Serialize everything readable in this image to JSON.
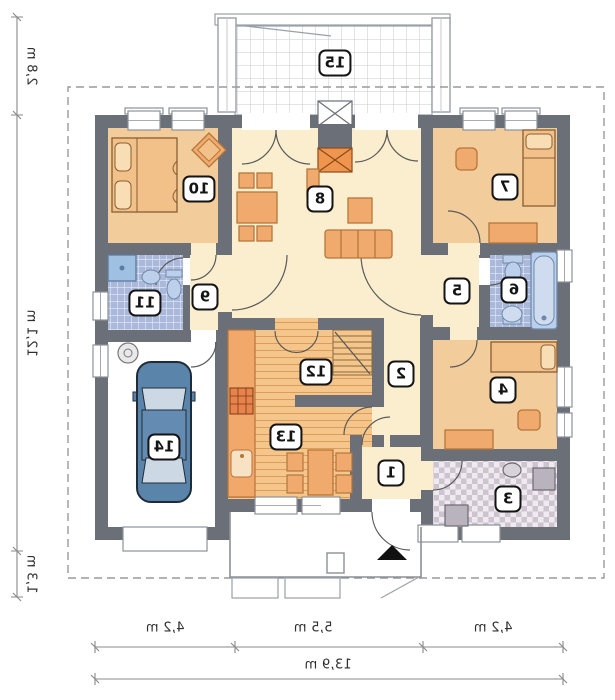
{
  "title": "Single-storey house floor plan (mirrored print)",
  "rooms": [
    {
      "number": "1"
    },
    {
      "number": "2"
    },
    {
      "number": "3"
    },
    {
      "number": "4"
    },
    {
      "number": "5"
    },
    {
      "number": "6"
    },
    {
      "number": "7"
    },
    {
      "number": "8"
    },
    {
      "number": "9"
    },
    {
      "number": "10"
    },
    {
      "number": "11"
    },
    {
      "number": "12"
    },
    {
      "number": "13"
    },
    {
      "number": "14"
    },
    {
      "number": "15"
    }
  ],
  "dimensions": {
    "vertical": [
      "2,8 m",
      "12,1 m",
      "1,3 m"
    ],
    "horizontal": [
      "4,2 m",
      "5,5 m",
      "4,2 m"
    ],
    "total_width": "13,9 m"
  },
  "markers": {
    "entrance_arrow": "▲"
  },
  "colors": {
    "wall": "#6b6f78",
    "floor_cream": "#faeecf",
    "floor_tan": "#f2cc9b",
    "furniture_orange": "#f0aa6e",
    "tile_blue": "#a9b8db",
    "wood_floor": "#f5c68b",
    "utility_tile": "#cdc4cf",
    "car_blue": "#5b84ab",
    "fireplace_orange": "#f0954e",
    "dash_line": "#9a9a9a"
  }
}
